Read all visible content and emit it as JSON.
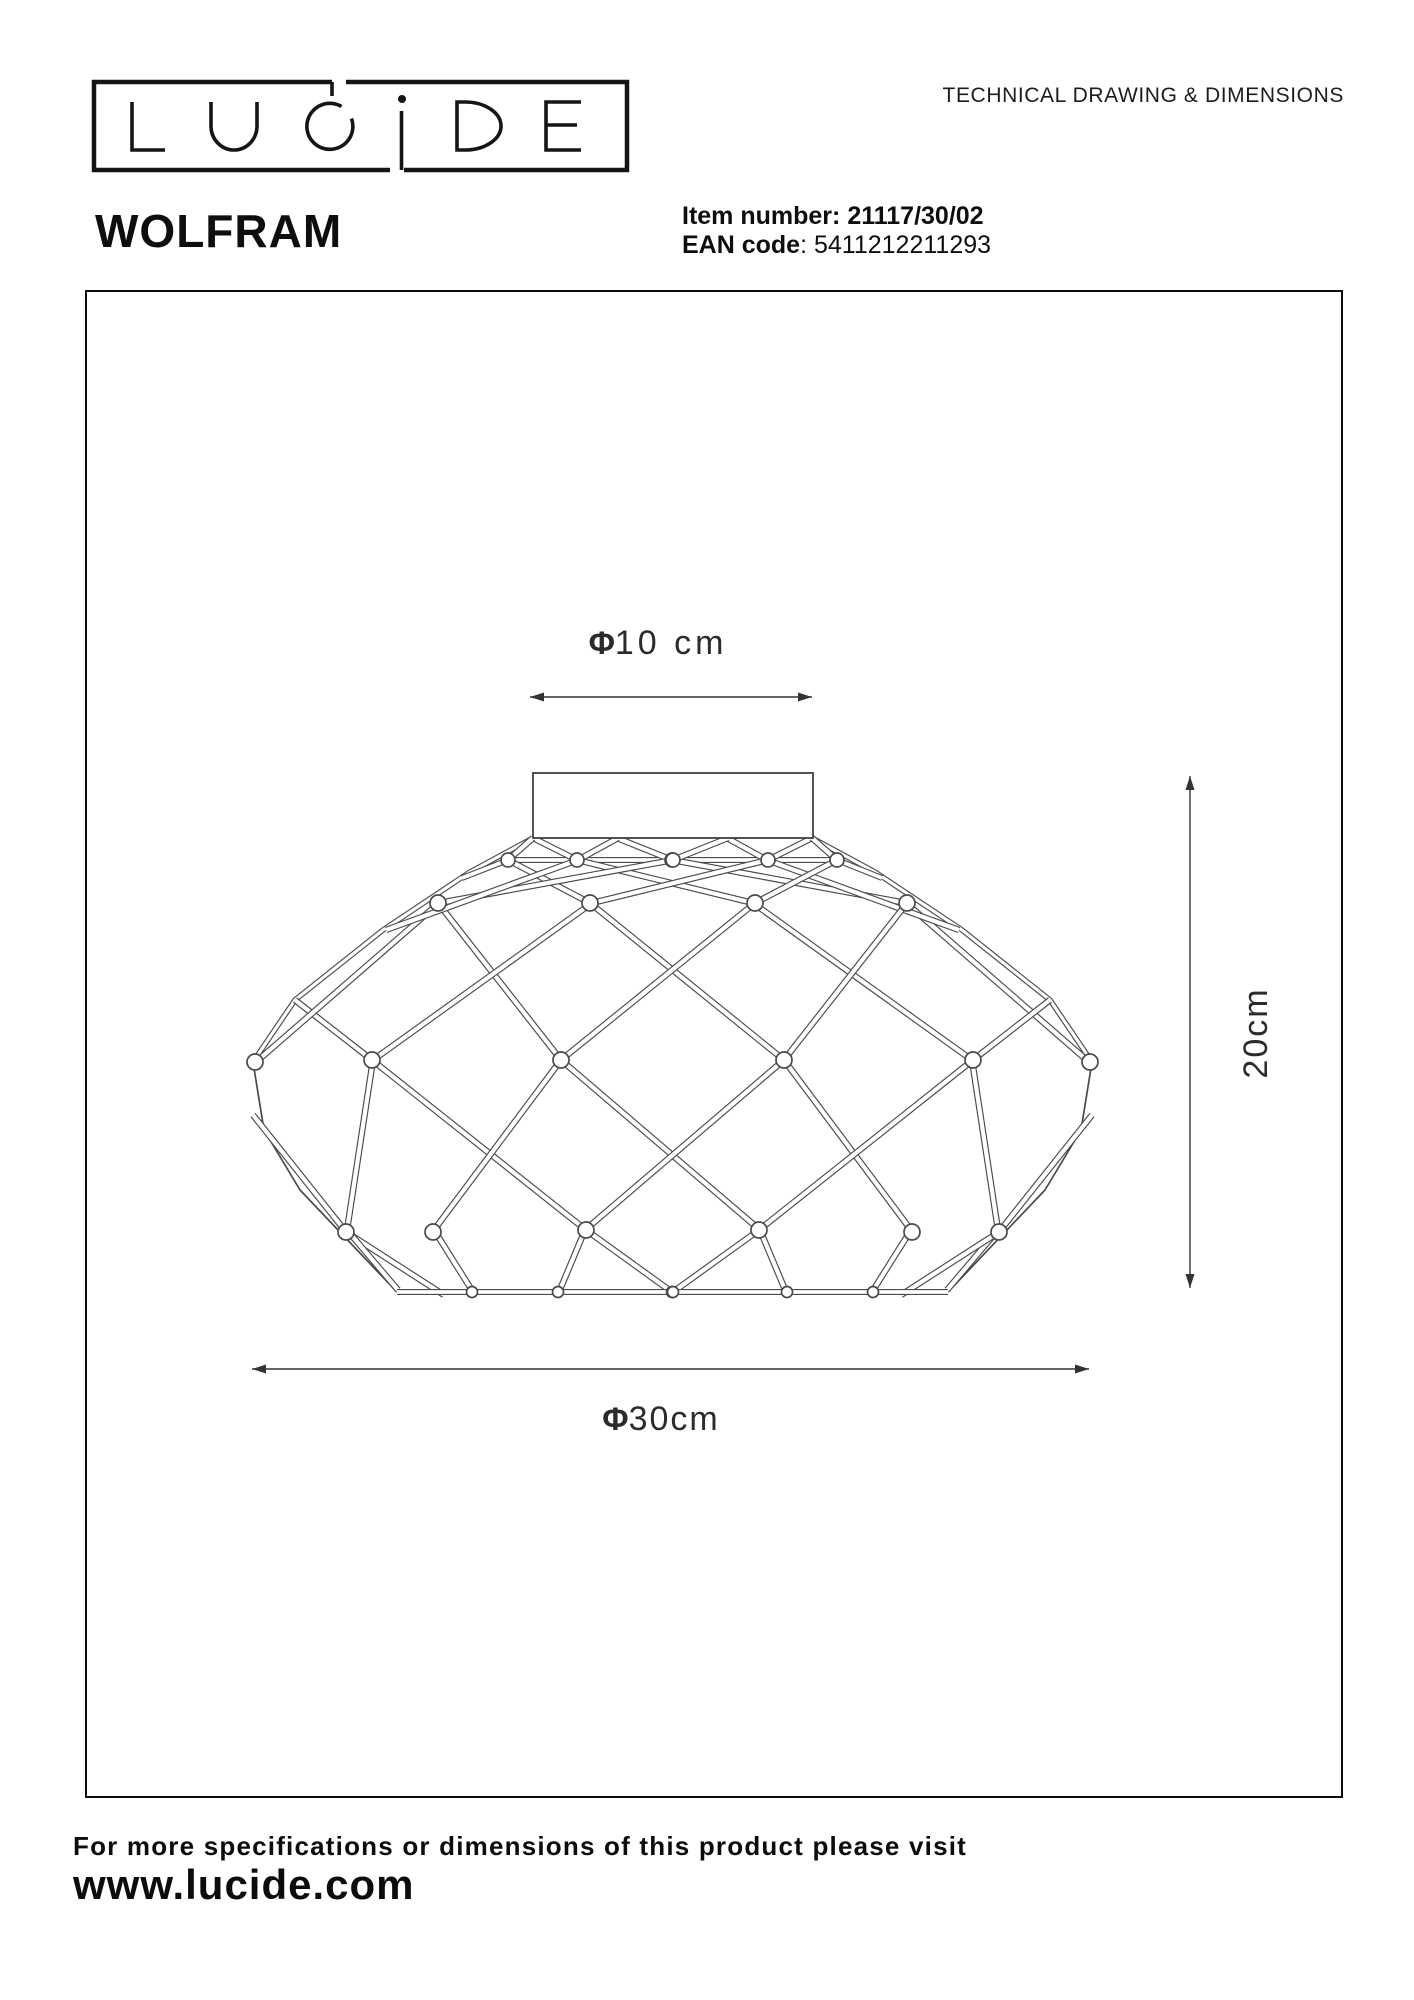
{
  "header": {
    "doc_title": "TECHNICAL DRAWING & DIMENSIONS"
  },
  "logo": {
    "brand": "LUCIDE"
  },
  "product": {
    "name": "WOLFRAM",
    "item_number_label": "Item number:",
    "item_number": "21117/30/02",
    "ean_label": "EAN code",
    "ean_value": ": 5411212211293"
  },
  "dimensions": {
    "top": {
      "symbol": "Φ",
      "value": "10 cm"
    },
    "bottom": {
      "symbol": "Φ",
      "value": "30cm"
    },
    "side": {
      "value": "20cm"
    }
  },
  "footer": {
    "line1": "For more specifications or dimensions of this product please visit",
    "website": "www.lucide.com"
  },
  "colors": {
    "ink": "#111111",
    "drawing_line": "#4a4a4a",
    "dimension_line": "#333333"
  }
}
